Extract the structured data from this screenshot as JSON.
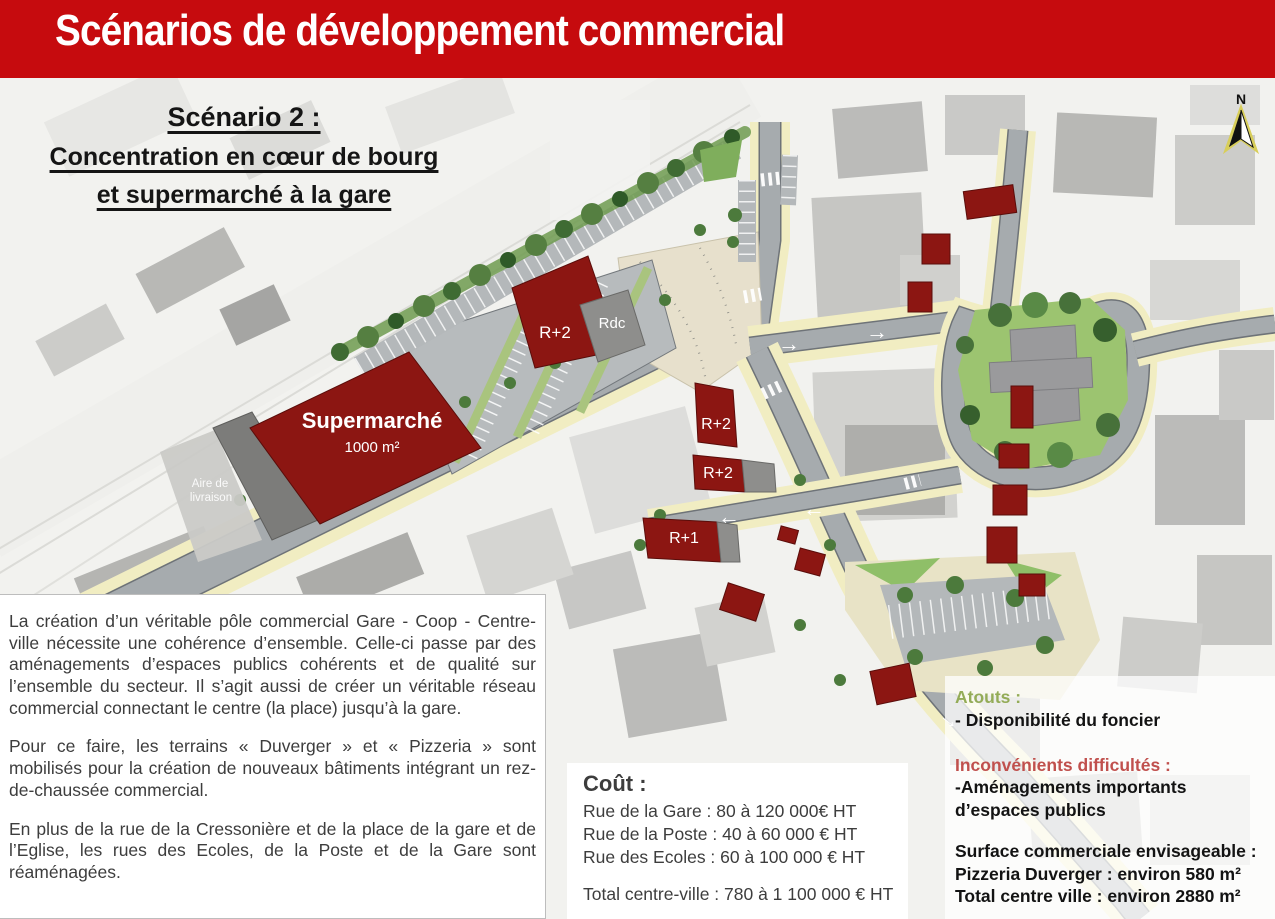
{
  "header": {
    "title": "Scénarios de développement commercial",
    "bg_color": "#c60b0e"
  },
  "subtitle": {
    "line1": "Scénario 2 :",
    "line2": "Concentration en cœur de bourg",
    "line3": "et supermarché à la gare"
  },
  "map": {
    "north_label": "N",
    "arrow_right": "→",
    "arrow_left": "←",
    "labels": {
      "supermarket": "Supermarché",
      "supermarket_area": "1000 m²",
      "delivery_line1": "Aire de",
      "delivery_line2": "livraison",
      "building_r2_a": "R+2",
      "building_rdc": "Rdc",
      "building_r2_b": "R+2",
      "building_r2_c": "R+2",
      "building_r1": "R+1"
    },
    "colors": {
      "proposed_building": "#8c1612",
      "existing_building": "#a8a8a5",
      "road": "#a6abae",
      "sidewalk": "#f1edc2",
      "plaza": "#e7e0cc",
      "green": "#8fbf68"
    }
  },
  "description": {
    "para1": "La création d’un véritable pôle commercial Gare - Coop - Centre-ville nécessite une cohérence d’ensemble. Celle-ci passe par des aménagements d’espaces publics cohérents et de qualité sur l’ensemble du secteur. Il s’agit aussi de créer un véritable réseau commercial connectant le centre (la place) jusqu’à la gare.",
    "para2": "Pour ce faire, les terrains « Duverger » et « Pizzeria » sont mobilisés pour la création de nouveaux bâtiments intégrant un rez-de-chaussée commercial.",
    "para3": "En plus de la rue de la Cressonière et de la place de la gare et de l’Eglise, les rues  des Ecoles, de la Poste et de la Gare sont réaménagées."
  },
  "cost": {
    "title": "Coût :",
    "lines": [
      "Rue de la Gare : 80 à 120 000€ HT",
      "Rue de la Poste : 40 à 60 000 € HT",
      "Rue des Ecoles : 60 à 100 000 € HT"
    ],
    "total": "Total centre-ville : 780 à 1 100 000 € HT"
  },
  "assessment": {
    "atouts_title": "Atouts :",
    "atouts_item": "- Disponibilité du foncier",
    "atouts_color": "#94ac58",
    "inconvenients_title": "Inconvénients difficultés :",
    "inconvenients_item": "-Aménagements importants d’espaces publics",
    "inconvenients_color": "#c0504d",
    "surface_title": "Surface commerciale envisageable :",
    "surface_line1": "Pizzeria Duverger : environ 580 m²",
    "surface_line2": "Total centre ville : environ 2880 m²"
  }
}
